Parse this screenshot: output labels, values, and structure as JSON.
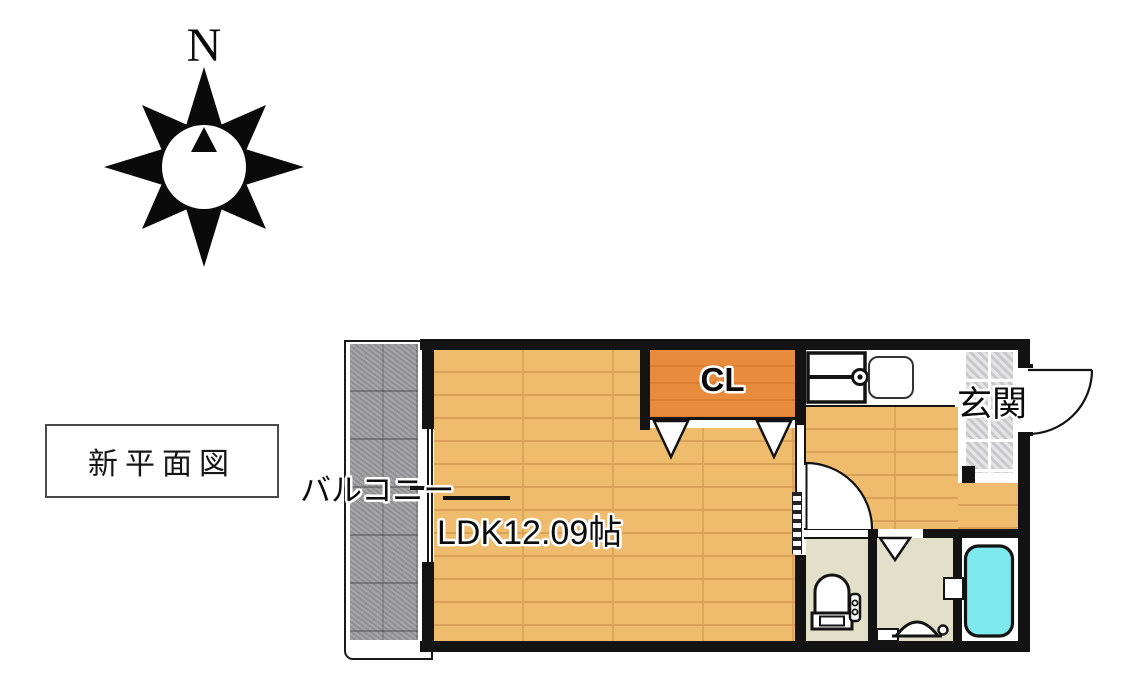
{
  "compass": {
    "north_label": "N"
  },
  "legend": {
    "title": "新平面図"
  },
  "labels": {
    "balcony": "バルコニー",
    "ldk": "LDK12.09帖",
    "closet": "CL",
    "entrance": "玄関"
  },
  "colors": {
    "wall": "#131313",
    "wood": "#efbc6d",
    "wood-line": "#d9a258",
    "closet": "#e98b3c",
    "closet-line": "#dd7f30",
    "balcony": "#9b9b9d",
    "tile": "#d6d6d8",
    "wet-floor": "#e2e0c8",
    "tub": "#7ee9ed"
  }
}
